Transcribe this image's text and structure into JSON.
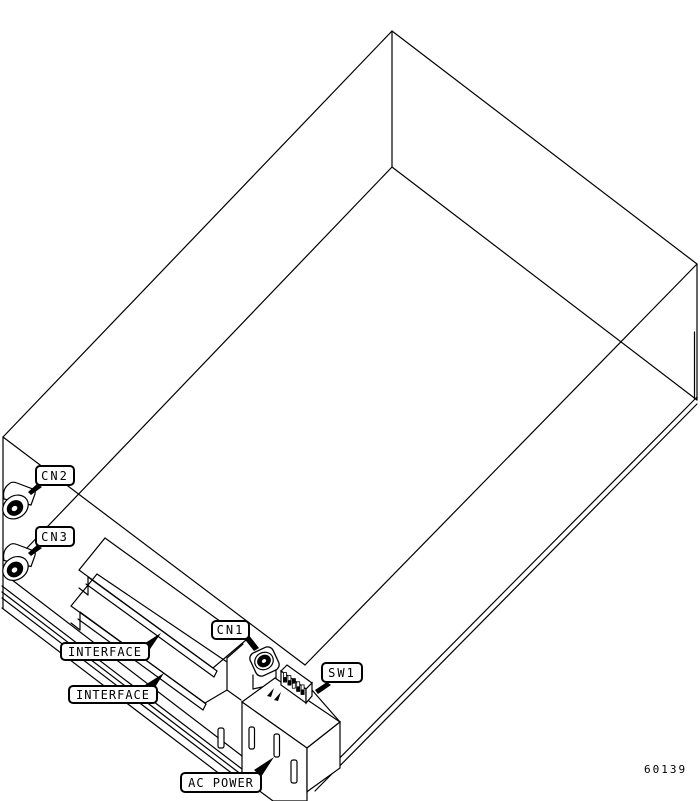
{
  "figure": {
    "number": "60139",
    "labels": {
      "cn2": "CN2",
      "cn3": "CN3",
      "cn1": "CN1",
      "sw1": "SW1",
      "interface_top": "INTERFACE",
      "interface_bottom": "INTERFACE",
      "ac_power": "AC POWER"
    },
    "colors": {
      "line": "#000000",
      "background": "#ffffff"
    }
  }
}
